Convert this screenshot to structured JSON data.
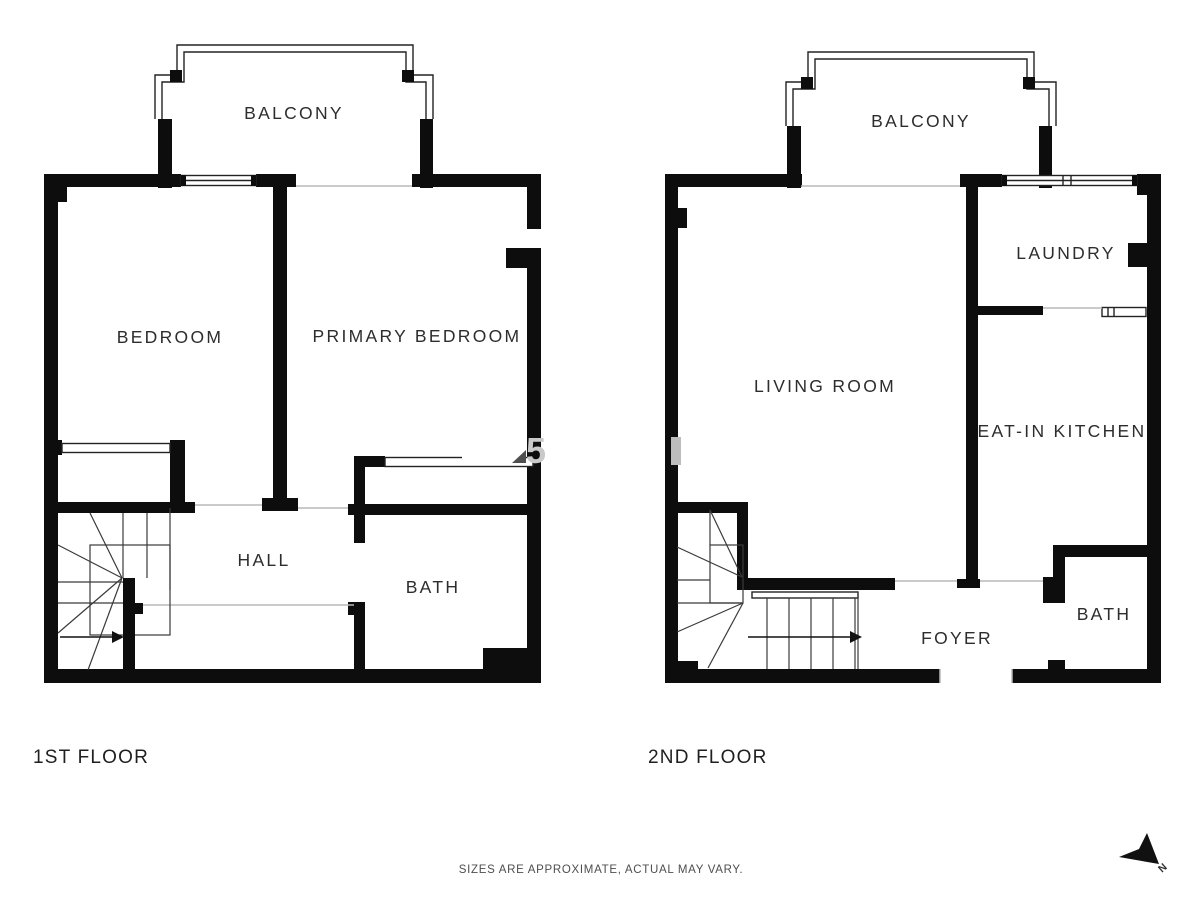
{
  "floors": [
    {
      "label": "1ST FLOOR",
      "rooms": [
        {
          "name": "BALCONY"
        },
        {
          "name": "BEDROOM"
        },
        {
          "name": "PRIMARY BEDROOM"
        },
        {
          "name": "HALL"
        },
        {
          "name": "BATH"
        }
      ]
    },
    {
      "label": "2ND FLOOR",
      "rooms": [
        {
          "name": "BALCONY"
        },
        {
          "name": "LAUNDRY"
        },
        {
          "name": "LIVING ROOM"
        },
        {
          "name": "EAT-IN KITCHEN"
        },
        {
          "name": "FOYER"
        },
        {
          "name": "BATH"
        }
      ]
    }
  ],
  "disclaimer": {
    "text": "SIZES ARE APPROXIMATE, ACTUAL MAY VARY."
  },
  "compass": {
    "label": "N"
  },
  "watermark": {
    "fragment": "5"
  },
  "colors": {
    "wall": "#0d0d0d",
    "room_label": "#2d2d2d",
    "floor_label": "#1f1f1f",
    "disclaimer": "#4e4e4e",
    "watermark_gray": "#c9c9c9"
  }
}
